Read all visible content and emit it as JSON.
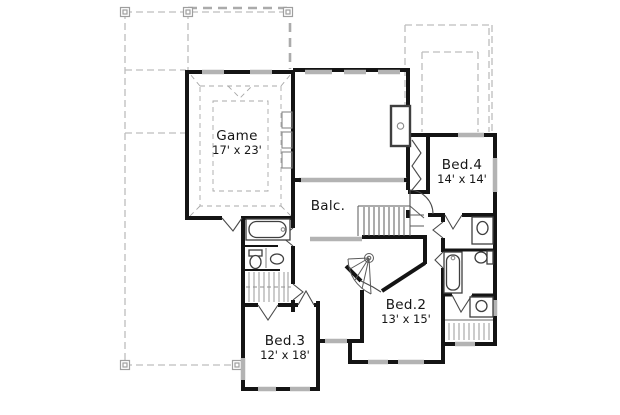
{
  "plan": {
    "type": "floor-plan",
    "rooms": {
      "game": {
        "name": "Game",
        "dims": "17' x 23'"
      },
      "balcony": {
        "name": "Balc."
      },
      "bed4": {
        "name": "Bed.4",
        "dims": "14' x 14'"
      },
      "bed2": {
        "name": "Bed.2",
        "dims": "13' x 15'"
      },
      "bed3": {
        "name": "Bed.3",
        "dims": "12' x 18'"
      }
    },
    "fixtures": [
      "staircase",
      "bathtub",
      "toilet",
      "sink-vanity",
      "closet-rod",
      "media-niche",
      "balcony-railing"
    ],
    "colors": {
      "wall": "#141414",
      "window": "#b3b3b3",
      "roof": "#bdbdbd",
      "text": "#161616",
      "bg": "#ffffff"
    }
  }
}
